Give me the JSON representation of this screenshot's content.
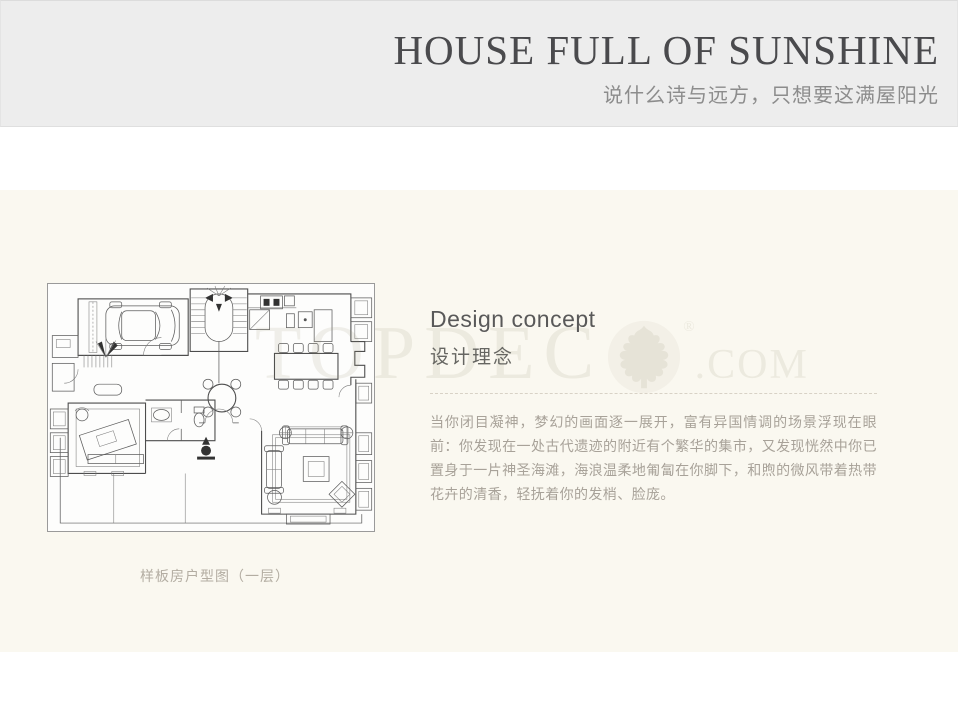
{
  "header": {
    "title": "HOUSE FULL OF SUNSHINE",
    "subtitle": "说什么诗与远方，只想要这满屋阳光"
  },
  "content": {
    "section_title_en": "Design concept",
    "section_title_zh": "设计理念",
    "paragraph": "当你闭目凝神，梦幻的画面逐一展开，富有异国情调的场景浮现在眼前：你发现在一处古代遗迹的附近有个繁华的集市，又发现恍然中你已置身于一片神圣海滩，海浪温柔地匍匐在你脚下，和煦的微风带着热带花卉的清香，轻抚着你的发梢、脸庞。",
    "floorplan_caption": "样板房户型图（一层）"
  },
  "watermark": {
    "letters": "TOPDEC",
    "registered": "®",
    "domain": ".COM",
    "logo_icon": "oak-leaf-icon"
  },
  "colors": {
    "header_bg": "#ededed",
    "band_bg": "#faf8f0",
    "title": "#4a4a4d",
    "subtitle": "#8c8c8c",
    "body_text": "#a8a299",
    "caption": "#b3ada2",
    "dashed_rule": "#d8d2c6"
  }
}
